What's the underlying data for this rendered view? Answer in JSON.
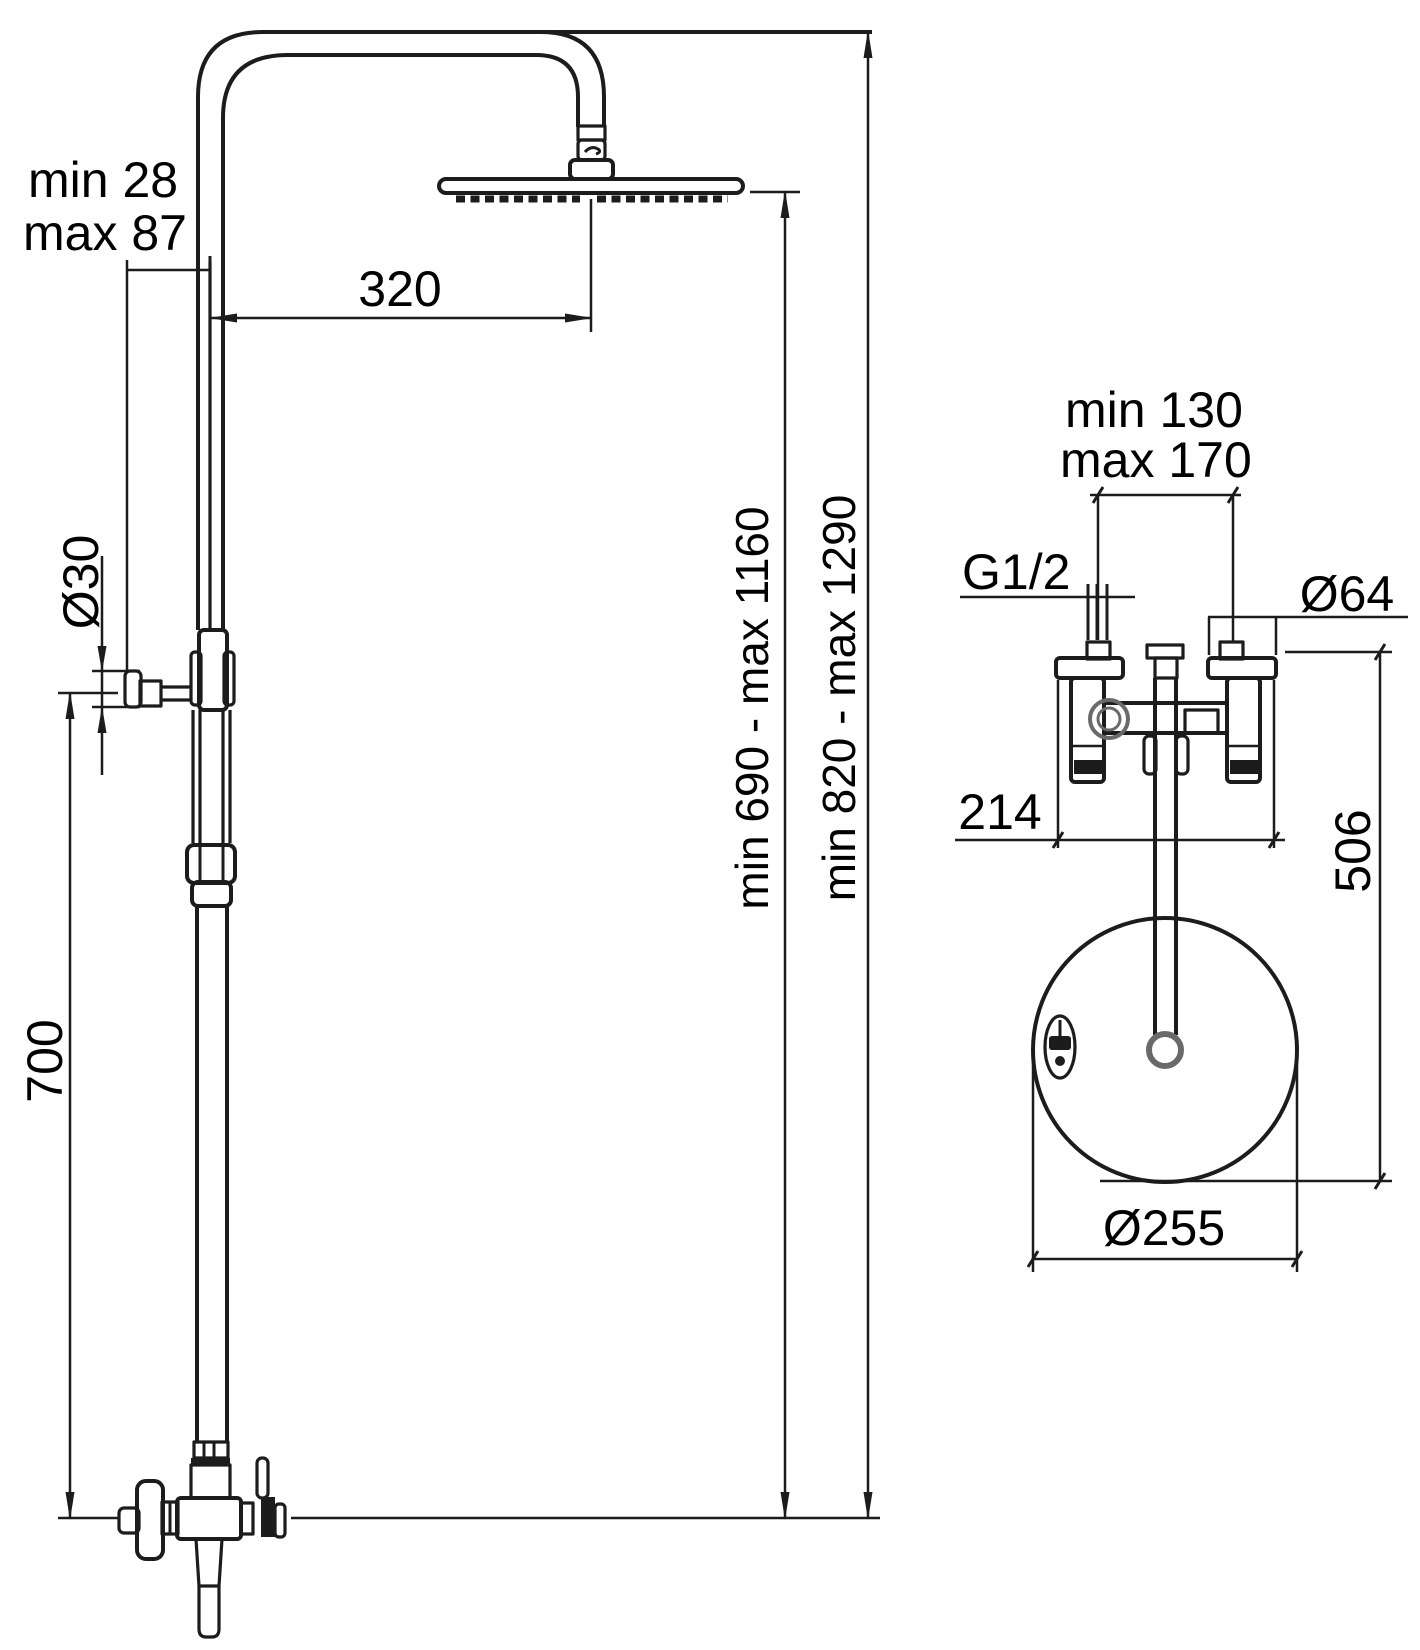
{
  "colors": {
    "background": "#ffffff",
    "line": "#1c1c1c",
    "text": "#000000"
  },
  "front_view": {
    "labels": {
      "wall_clearance_line1": "min 28",
      "wall_clearance_line2": "max 87",
      "arm_projection": "320",
      "bracket_diameter": "Ø30",
      "lower_riser_length": "700",
      "head_height_range": "min 690 - max 1160",
      "overall_height_range": "min 820 - max 1290"
    }
  },
  "top_view": {
    "labels": {
      "inlet_spacing_line1": "min 130",
      "inlet_spacing_line2": "max 170",
      "inlet_thread": "G1/2",
      "inlet_escutcheon_diameter": "Ø64",
      "body_width": "214",
      "head_projection": "506",
      "head_diameter": "Ø255"
    }
  }
}
